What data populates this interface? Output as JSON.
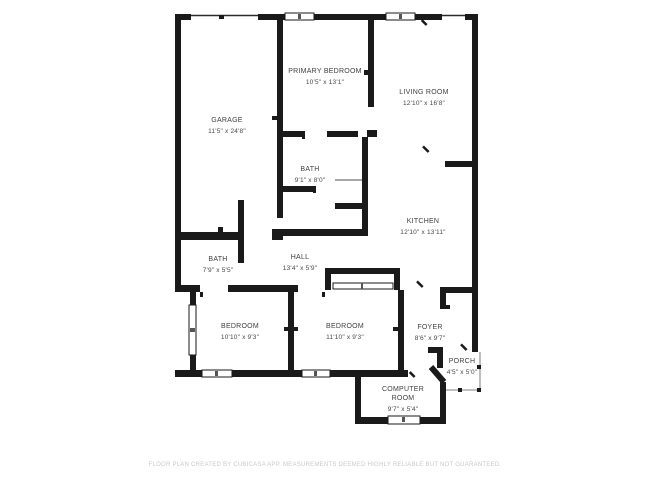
{
  "plan": {
    "background": "#ffffff",
    "wall_color": "#1a1a1a",
    "text_color": "#3f3f3f",
    "footer_color": "#c9c9c9"
  },
  "rooms": [
    {
      "id": "garage",
      "name": "GARAGE",
      "dims": "11'5\" x 24'8\""
    },
    {
      "id": "primary-bedroom",
      "name": "PRIMARY BEDROOM",
      "dims": "10'5\" x 13'1\""
    },
    {
      "id": "living-room",
      "name": "LIVING ROOM",
      "dims": "12'10\" x 16'8\""
    },
    {
      "id": "bath-upper",
      "name": "BATH",
      "dims": "9'1\" x 8'0\""
    },
    {
      "id": "kitchen",
      "name": "KITCHEN",
      "dims": "12'10\" x 13'11\""
    },
    {
      "id": "bath-lower",
      "name": "BATH",
      "dims": "7'9\" x 5'5\""
    },
    {
      "id": "hall",
      "name": "HALL",
      "dims": "13'4\" x 5'9\""
    },
    {
      "id": "bedroom-left",
      "name": "BEDROOM",
      "dims": "10'10\" x 9'3\""
    },
    {
      "id": "bedroom-right",
      "name": "BEDROOM",
      "dims": "11'10\" x 9'3\""
    },
    {
      "id": "foyer",
      "name": "FOYER",
      "dims": "8'6\" x 9'7\""
    },
    {
      "id": "porch",
      "name": "PORCH",
      "dims": "4'5\" x 5'0\""
    },
    {
      "id": "computer-room",
      "name": "COMPUTER ROOM",
      "dims": "9'7\" x 5'4\""
    }
  ],
  "footer": {
    "text": "FLOOR PLAN CREATED BY CUBICASA APP. MEASUREMENTS DEEMED HIGHLY RELIABLE BUT NOT GUARANTEED."
  }
}
